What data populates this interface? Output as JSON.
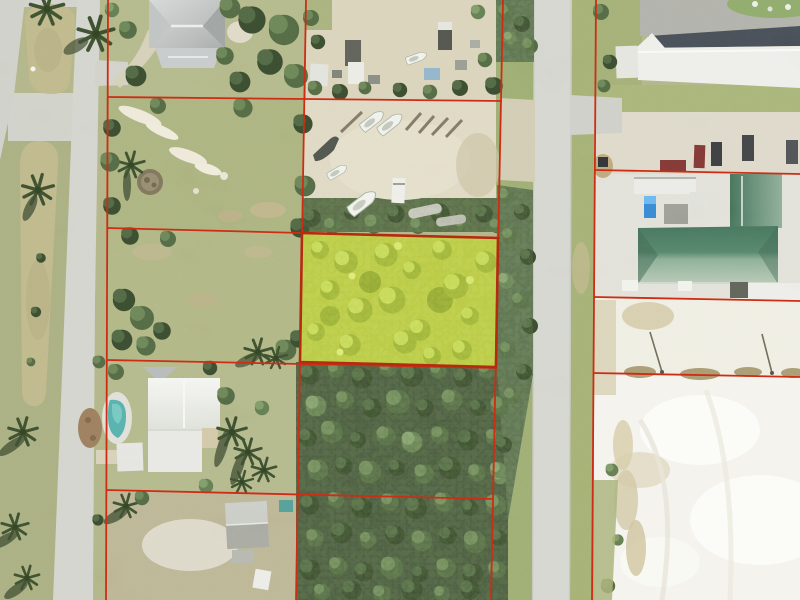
{
  "view": {
    "kind": "aerial-parcel-photo",
    "width_px": 800,
    "height_px": 600
  },
  "colors": {
    "parcel_line": "#ce2d15",
    "highlight_fill": "#a9bd2e",
    "highlight_border": "#b52b10",
    "road": "#cbccc5",
    "sand_lot": "#f1f0ea",
    "forest": "#31432a",
    "green_roof_dark": "#35684e",
    "white_roof": "#e9eae5",
    "pool": "#3fa3a0",
    "grass": "#9da66f",
    "dirt_yard": "#d3cbb1"
  },
  "features": {
    "highlighted_parcel": "highlighted wooded parcel (center)",
    "west_road": "divided boulevard with palm median",
    "center_road": "two-lane street",
    "northwest": "gray hip-roof house",
    "north_center": "boat and trailer storage yard",
    "northeast": "white flat-roof commercial building with parking",
    "east": "green hip-roof building",
    "southwest": "white-roof house with swimming pool",
    "south_center": "gray shed and dense tree stand",
    "southeast": "white sand lot"
  }
}
